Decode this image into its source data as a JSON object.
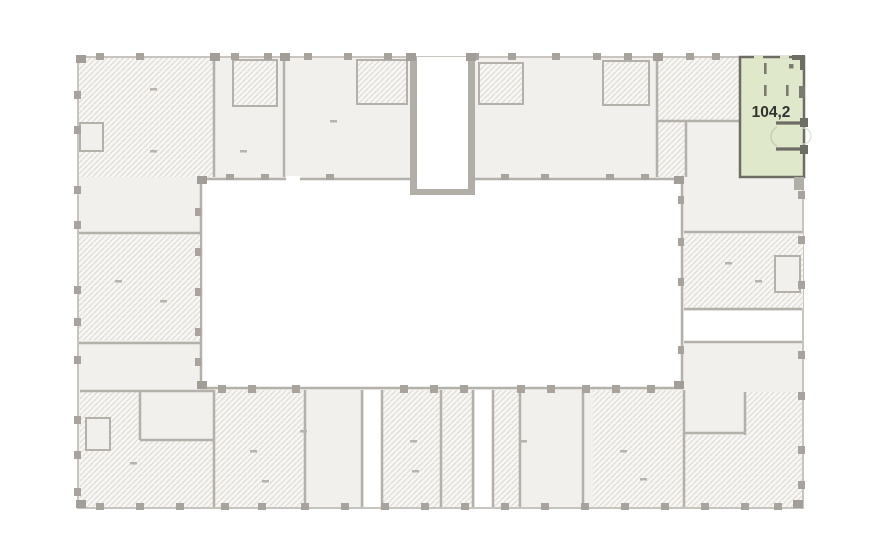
{
  "floor_plan": {
    "highlighted_unit": {
      "area_label": "104,2",
      "fill": "#dfe8cb",
      "stroke": "#6e6d64",
      "label_color": "#33332f"
    },
    "palette": {
      "background": "#ffffff",
      "unit_fill": "#f1f0ed",
      "hatch_base": "#f7f6f3",
      "hatch_line": "#dcd8d3",
      "wall": "#b4b0aa",
      "wall_dark": "#a29d96",
      "outline": "#c8c4bf"
    }
  }
}
